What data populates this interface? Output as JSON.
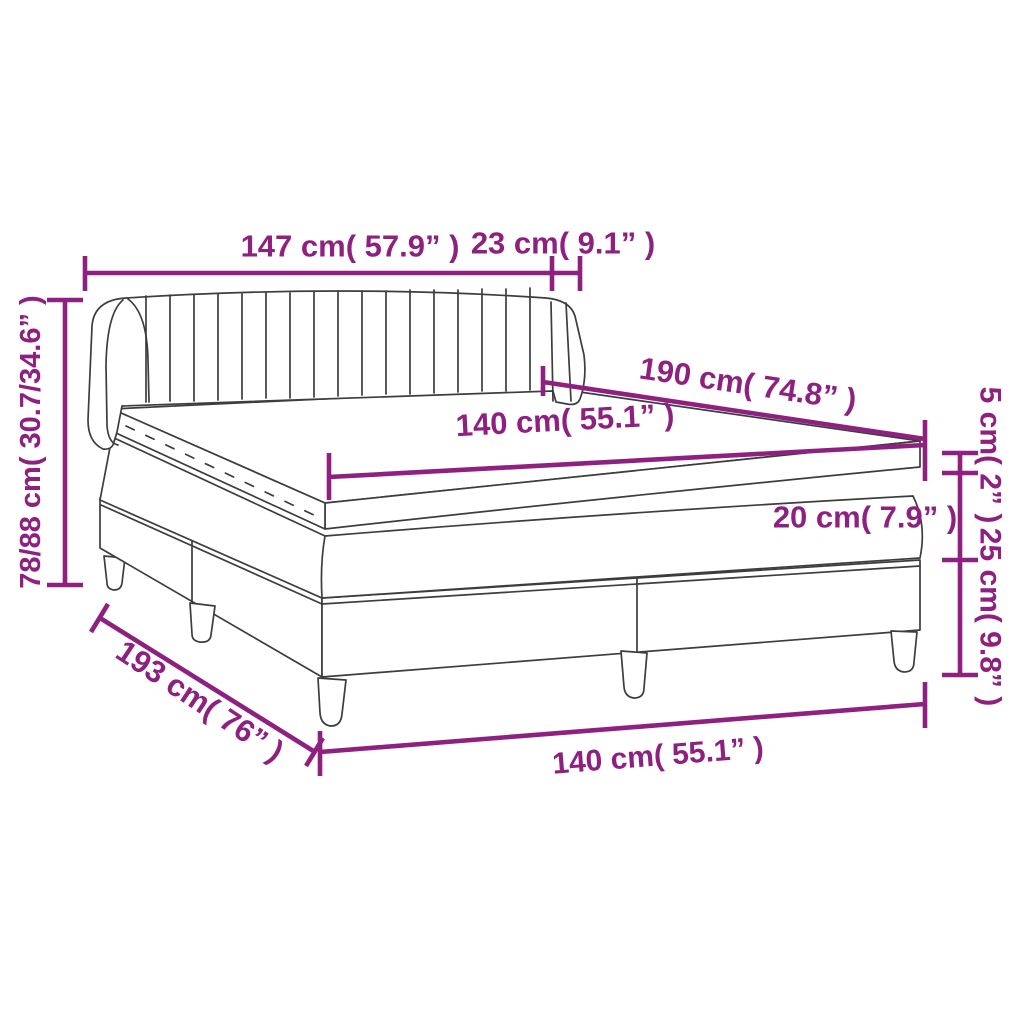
{
  "diagram": {
    "title": "Box spring bed with topper — dimension diagram",
    "colors": {
      "dimension_accent": "#8E2180",
      "lineart": "#3D3D3D",
      "background": "#FFFFFF"
    },
    "labels": {
      "headboard_width": "147 cm( 57.9” )",
      "headboard_wing_depth": "23 cm( 9.1” )",
      "overall_height": "78/88 cm( 30.7/34.6” )",
      "bed_length_top": "190 cm( 74.8” )",
      "mattress_width_top": "140 cm( 55.1” )",
      "topper_thickness": "5 cm( 2” )",
      "mattress_thickness": "20 cm( 7.9” )",
      "base_with_legs_height": "25 cm( 9.8” )",
      "overall_length": "193 cm( 76” )",
      "bed_width_bottom": "140 cm( 55.1” )"
    },
    "parts": {
      "headboard": "channel-tufted headboard with side wings",
      "topper": "mattress topper",
      "mattress": "mattress",
      "base": "two-section box spring base",
      "legs": "tapered cylindrical legs"
    }
  }
}
